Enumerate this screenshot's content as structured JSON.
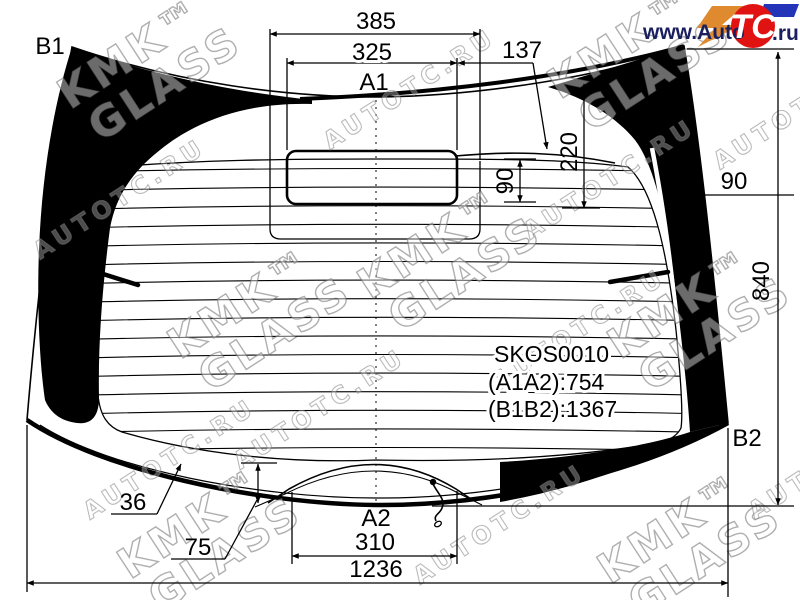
{
  "labels": {
    "b1": "B1",
    "b2": "B2",
    "a1": "A1",
    "a2": "A2"
  },
  "dimensions": {
    "top_width_outer": "385",
    "top_width_inner": "325",
    "top_offset_right": "137",
    "cutout_height": "90",
    "top_band_height": "220",
    "right_band_width": "90",
    "glass_height": "840",
    "band_width_bottom_left": "36",
    "bottom_edge_gap": "75",
    "bottom_cutout_width": "310",
    "glass_width": "1236"
  },
  "part_info": {
    "code": "SKOS0010",
    "dim_a": "(A1A2):754",
    "dim_b": "(B1B2):1367"
  },
  "logo": {
    "prefix": "www.Auto",
    "emblem": "TC",
    "suffix": ".ru"
  },
  "watermarks": {
    "brand_top": "KMK™",
    "brand_bottom": "GLASS",
    "site": "AUTOTC.RU"
  },
  "colors": {
    "line": "#000000",
    "logo_red": "#e01212",
    "logo_orange": "#e08a30",
    "logo_blue": "#2334b8",
    "logo_text": "#1a1f5e"
  }
}
